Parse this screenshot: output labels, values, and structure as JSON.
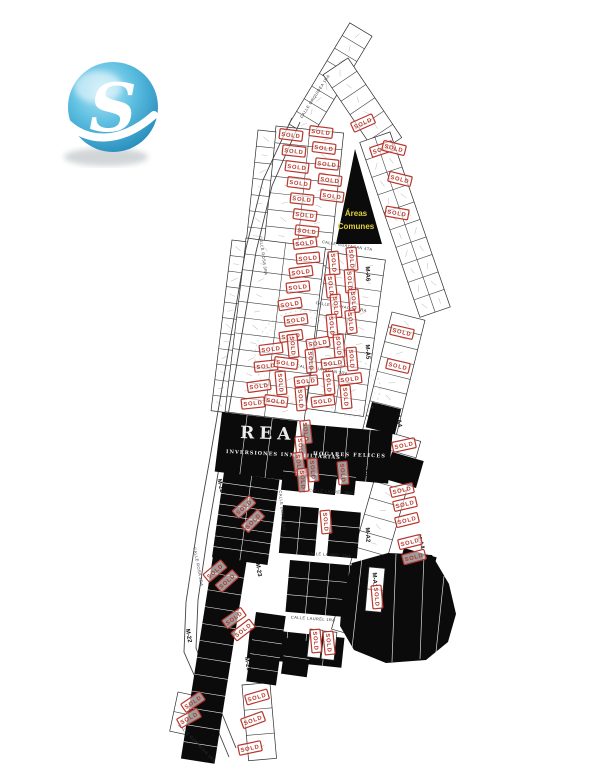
{
  "logo": {
    "letter": "S"
  },
  "map": {
    "sold_stamp_text": "SOLD",
    "common_area": {
      "line1": "Áreas",
      "line2": "Comunes",
      "x": 356,
      "y": 216
    },
    "watermarks": [
      {
        "t": "REAL",
        "x": 240,
        "y": 438,
        "r": 2,
        "s": 17,
        "ls": 5
      },
      {
        "t": "INVERSIONES INMOBILIARIAS",
        "x": 226,
        "y": 453,
        "r": 3,
        "s": 5,
        "ls": 1
      },
      {
        "t": "HOGARES FELICES",
        "x": 313,
        "y": 455,
        "r": 2,
        "s": 5,
        "ls": 1.2
      }
    ],
    "street_labels": [
      {
        "t": "CALLE ORQUIDEA 1RA",
        "x": 316,
        "y": 97,
        "r": -57,
        "s": 4
      },
      {
        "t": "CALLE GUAYACAN 4TA",
        "x": 347,
        "y": 247,
        "r": 9,
        "s": 4
      },
      {
        "t": "CALLE GUAYACAN 3RA",
        "x": 341,
        "y": 308,
        "r": 9,
        "s": 4
      },
      {
        "t": "CALLE GUAYACAN 2DA",
        "x": 322,
        "y": 371,
        "r": 9,
        "s": 4
      },
      {
        "t": "CALLE GUAYACAN 1RA",
        "x": 196,
        "y": 744,
        "r": 46,
        "s": 4
      },
      {
        "t": "CALLE ROSA 3RA",
        "x": 262,
        "y": 256,
        "r": 82,
        "s": 4
      },
      {
        "t": "CALLE DOBLE VIA",
        "x": 281,
        "y": 511,
        "r": 84,
        "s": 4
      },
      {
        "t": "CALLE ROSA 2DA",
        "x": 197,
        "y": 567,
        "r": 79,
        "s": 4
      },
      {
        "t": "CALLE LAUREL 3RA",
        "x": 331,
        "y": 493,
        "r": 4,
        "s": 4
      },
      {
        "t": "CALLE LAUREL 2DA",
        "x": 329,
        "y": 556,
        "r": 4,
        "s": 4
      },
      {
        "t": "CALLE LAUREL 1RA",
        "x": 313,
        "y": 620,
        "r": 4,
        "s": 4
      }
    ],
    "block_labels": [
      {
        "t": "M-22",
        "x": 219,
        "y": 486,
        "r": 77
      },
      {
        "t": "M-22",
        "x": 187,
        "y": 636,
        "r": 80
      },
      {
        "t": "M-23",
        "x": 257,
        "y": 570,
        "r": 80
      },
      {
        "t": "M-23",
        "x": 246,
        "y": 664,
        "r": 80
      },
      {
        "t": "M-A3",
        "x": 363,
        "y": 469,
        "r": 87
      },
      {
        "t": "M-A2",
        "x": 366,
        "y": 535,
        "r": 87
      },
      {
        "t": "M-A1",
        "x": 373,
        "y": 580,
        "r": 87
      },
      {
        "t": "M-A4",
        "x": 397,
        "y": 420,
        "r": 80
      },
      {
        "t": "M-A4",
        "x": 419,
        "y": 542,
        "r": 74
      },
      {
        "t": "M-A5",
        "x": 366,
        "y": 352,
        "r": 87
      },
      {
        "t": "M-A6",
        "x": 366,
        "y": 274,
        "r": 87
      }
    ],
    "white_grids": [
      {
        "x": 289,
        "y": 124,
        "r": -59,
        "w": 118,
        "h": 26,
        "rows": 1,
        "cols": 8
      },
      {
        "x": 348,
        "y": 58,
        "r": 56,
        "w": 96,
        "h": 30,
        "rows": 1,
        "cols": 6
      },
      {
        "x": 276,
        "y": 126,
        "r": 6,
        "w": 68,
        "h": 134,
        "rows": 8,
        "cols": 2
      },
      {
        "x": 258,
        "y": 130,
        "r": 6,
        "w": 18,
        "h": 130,
        "rows": 8,
        "cols": 1
      },
      {
        "x": 390,
        "y": 132,
        "r": 71,
        "w": 185,
        "h": 32,
        "rows": 2,
        "cols": 10
      },
      {
        "x": 246,
        "y": 238,
        "r": 7,
        "w": 80,
        "h": 175,
        "rows": 11,
        "cols": 2
      },
      {
        "x": 328,
        "y": 252,
        "r": 8,
        "w": 58,
        "h": 158,
        "rows": 10,
        "cols": 2
      },
      {
        "x": 232,
        "y": 240,
        "r": 7,
        "w": 14,
        "h": 172,
        "rows": 11,
        "cols": 1
      },
      {
        "x": 392,
        "y": 312,
        "r": 14,
        "w": 34,
        "h": 122,
        "rows": 8,
        "cols": 1
      },
      {
        "x": 388,
        "y": 432,
        "r": 16,
        "w": 34,
        "h": 205,
        "rows": 12,
        "cols": 1
      },
      {
        "x": 242,
        "y": 685,
        "r": -5,
        "w": 28,
        "h": 76,
        "rows": 3,
        "cols": 1
      },
      {
        "x": 178,
        "y": 692,
        "r": 12,
        "w": 30,
        "h": 40,
        "rows": 2,
        "cols": 1
      },
      {
        "x": 369,
        "y": 567,
        "r": 5,
        "w": 16,
        "h": 44,
        "rows": 2,
        "cols": 1,
        "l": 2
      },
      {
        "x": 310,
        "y": 629,
        "r": 6,
        "w": 13,
        "h": 28,
        "rows": 1,
        "cols": 1,
        "l": 2
      },
      {
        "x": 324,
        "y": 631,
        "r": 6,
        "w": 13,
        "h": 28,
        "rows": 1,
        "cols": 1,
        "l": 2
      }
    ],
    "black_grids": [
      {
        "x": 222,
        "y": 412,
        "r": 7,
        "w": 76,
        "h": 60,
        "rows": 1,
        "cols": 3
      },
      {
        "x": 303,
        "y": 424,
        "r": 5,
        "w": 90,
        "h": 52,
        "rows": 1,
        "cols": 4
      },
      {
        "x": 224,
        "y": 472,
        "r": 8,
        "w": 56,
        "h": 86,
        "rows": 8,
        "cols": 2
      },
      {
        "x": 285,
        "y": 452,
        "r": 6,
        "w": 24,
        "h": 38,
        "rows": 2,
        "cols": 1
      },
      {
        "x": 317,
        "y": 455,
        "r": 6,
        "w": 22,
        "h": 38,
        "rows": 2,
        "cols": 1
      },
      {
        "x": 344,
        "y": 458,
        "r": 6,
        "w": 14,
        "h": 36,
        "rows": 2,
        "cols": 1
      },
      {
        "x": 283,
        "y": 505,
        "r": 5,
        "w": 36,
        "h": 48,
        "rows": 3,
        "cols": 2
      },
      {
        "x": 331,
        "y": 510,
        "r": 5,
        "w": 30,
        "h": 46,
        "rows": 3,
        "cols": 1
      },
      {
        "x": 290,
        "y": 560,
        "r": 5,
        "w": 80,
        "h": 52,
        "rows": 3,
        "cols": 4
      },
      {
        "x": 250,
        "y": 628,
        "r": 6,
        "w": 95,
        "h": 30,
        "rows": 1,
        "cols": 5
      },
      {
        "x": 213,
        "y": 556,
        "r": 9,
        "w": 34,
        "h": 205,
        "rows": 12,
        "cols": 1
      },
      {
        "x": 256,
        "y": 612,
        "r": 8,
        "w": 30,
        "h": 70,
        "rows": 5,
        "cols": 1
      },
      {
        "x": 286,
        "y": 638,
        "r": 8,
        "w": 26,
        "h": 36,
        "rows": 2,
        "cols": 1
      },
      {
        "x": 392,
        "y": 452,
        "r": 16,
        "w": 33,
        "h": 28,
        "rows": 1,
        "cols": 1
      },
      {
        "x": 404,
        "y": 548,
        "r": 16,
        "w": 34,
        "h": 30,
        "rows": 1,
        "cols": 1
      },
      {
        "x": 372,
        "y": 402,
        "r": 14,
        "w": 30,
        "h": 26,
        "rows": 1,
        "cols": 1
      }
    ],
    "triangle": "355,149 382,244 336,244",
    "se_region": "342,600 352,563 388,553 432,555 449,584 456,614 448,642 426,660 386,663 354,650 340,626",
    "se_lines": [
      [
        362,
        558,
        352,
        648
      ],
      [
        396,
        554,
        392,
        662
      ],
      [
        424,
        556,
        420,
        659
      ],
      [
        444,
        576,
        436,
        652
      ]
    ],
    "boundary": [
      [
        [
          292,
          118
        ],
        [
          263,
          180
        ],
        [
          246,
          248
        ],
        [
          234,
          318
        ],
        [
          222,
          388
        ],
        [
          210,
          458
        ],
        [
          197,
          530
        ],
        [
          186,
          602
        ],
        [
          184,
          652
        ],
        [
          206,
          702
        ],
        [
          229,
          757
        ]
      ],
      [
        [
          300,
          122
        ],
        [
          272,
          186
        ],
        [
          256,
          252
        ],
        [
          244,
          322
        ],
        [
          232,
          392
        ],
        [
          220,
          462
        ],
        [
          208,
          532
        ],
        [
          198,
          600
        ],
        [
          196,
          648
        ],
        [
          214,
          694
        ],
        [
          236,
          748
        ]
      ]
    ],
    "wreaths": [
      {
        "cx": 301,
        "cy": 357,
        "r": 46
      },
      {
        "cx": 352,
        "cy": 388,
        "r": 28
      }
    ],
    "stamps": [
      [
        291,
        135,
        7
      ],
      [
        321,
        132,
        7
      ],
      [
        294,
        151,
        6
      ],
      [
        324,
        148,
        7
      ],
      [
        297,
        167,
        7
      ],
      [
        327,
        164,
        6
      ],
      [
        299,
        183,
        7
      ],
      [
        330,
        180,
        7
      ],
      [
        302,
        199,
        6
      ],
      [
        332,
        196,
        7
      ],
      [
        305,
        215,
        7
      ],
      [
        307,
        231,
        6
      ],
      [
        305,
        243,
        -7
      ],
      [
        308,
        258,
        -5
      ],
      [
        301,
        272,
        -8
      ],
      [
        298,
        287,
        -6
      ],
      [
        290,
        304,
        -9
      ],
      [
        296,
        320,
        -7
      ],
      [
        291,
        336,
        -8
      ],
      [
        334,
        263,
        85
      ],
      [
        352,
        259,
        85
      ],
      [
        331,
        286,
        84
      ],
      [
        350,
        281,
        86
      ],
      [
        336,
        306,
        85
      ],
      [
        354,
        301,
        85
      ],
      [
        332,
        326,
        85
      ],
      [
        351,
        322,
        84
      ],
      [
        271,
        349,
        -7
      ],
      [
        293,
        346,
        85
      ],
      [
        318,
        343,
        -9
      ],
      [
        339,
        346,
        85
      ],
      [
        266,
        366,
        -6
      ],
      [
        286,
        363,
        7
      ],
      [
        311,
        361,
        85
      ],
      [
        333,
        363,
        -7
      ],
      [
        352,
        359,
        85
      ],
      [
        259,
        386,
        -8
      ],
      [
        281,
        383,
        85
      ],
      [
        306,
        381,
        -6
      ],
      [
        329,
        383,
        85
      ],
      [
        350,
        379,
        -7
      ],
      [
        253,
        403,
        -6
      ],
      [
        276,
        401,
        7
      ],
      [
        301,
        399,
        85
      ],
      [
        323,
        401,
        -7
      ],
      [
        346,
        397,
        85
      ],
      [
        363,
        123,
        -24
      ],
      [
        382,
        149,
        -18
      ],
      [
        394,
        148,
        14
      ],
      [
        400,
        179,
        14
      ],
      [
        397,
        213,
        10
      ],
      [
        402,
        332,
        13
      ],
      [
        398,
        366,
        13
      ],
      [
        306,
        432,
        84
      ],
      [
        301,
        448,
        84
      ],
      [
        299,
        464,
        82
      ],
      [
        303,
        480,
        85
      ],
      [
        313,
        470,
        85
      ],
      [
        343,
        473,
        85
      ],
      [
        244,
        507,
        -42
      ],
      [
        253,
        521,
        -45
      ],
      [
        215,
        571,
        -40
      ],
      [
        227,
        581,
        -42
      ],
      [
        234,
        618,
        -35
      ],
      [
        243,
        630,
        -38
      ],
      [
        326,
        522,
        85
      ],
      [
        377,
        597,
        85
      ],
      [
        404,
        445,
        -12
      ],
      [
        402,
        490,
        -13
      ],
      [
        405,
        504,
        -13
      ],
      [
        407,
        520,
        -14
      ],
      [
        410,
        542,
        -14
      ],
      [
        414,
        557,
        -15
      ],
      [
        316,
        641,
        85
      ],
      [
        329,
        643,
        84
      ],
      [
        193,
        702,
        -34
      ],
      [
        189,
        718,
        -29
      ],
      [
        257,
        697,
        -16
      ],
      [
        253,
        720,
        -20
      ],
      [
        250,
        748,
        -12
      ]
    ],
    "colors": {
      "ink": "#2b2b2b",
      "stamp": "#b8362c",
      "black": "#0b0b0b",
      "yellow": "#e0cf3d",
      "boundary": "#444444",
      "mark": "#9a9a9a",
      "watermark": "#ffffff",
      "street_text": "#333333",
      "label_text": "#111111"
    }
  }
}
